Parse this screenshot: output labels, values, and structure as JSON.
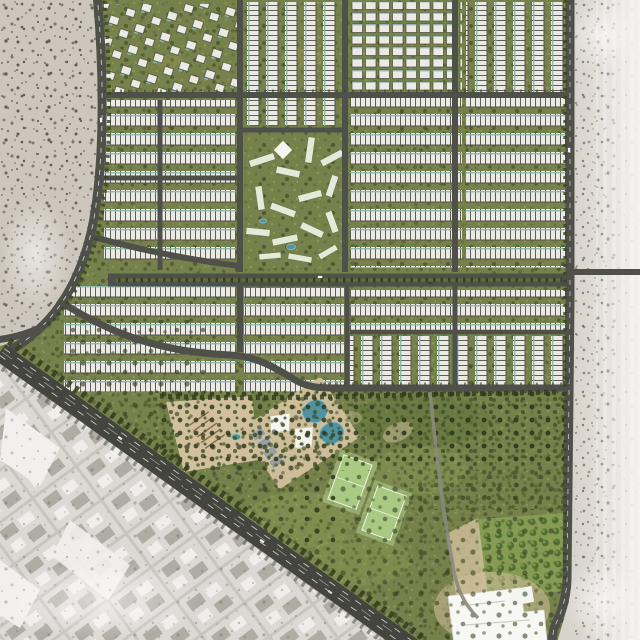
{
  "scene": {
    "name": "residential-masterplan-aerial",
    "description": "Top-down architectural rendering of a gated residential master-planned community surrounded by desert, an existing grayscale city district to the southwest and a diagonal arterial highway along its south-west edge",
    "canvas": {
      "width": 640,
      "height": 640
    }
  },
  "colors": {
    "left_desert": "#cdc6bc",
    "right_desert": "#d8d3cb",
    "city_base": "#dcd9d4",
    "city_block_gray": "#aba69e",
    "city_block_white": "#f2f0ec",
    "road": "#50504a",
    "road_major": "#454540",
    "lane_dash": "#c9c9c3",
    "dev_green": "#76814b",
    "green_dark": "#37411f",
    "green_light": "#9aa254",
    "housing_white": "#eae9e3",
    "housing_gap": "#45453c",
    "teal_accent": "#87b5ac",
    "villa_white": "#eceae4",
    "park_tree": "#2c3a1a",
    "median_green": "#5e6c3c",
    "pitch_green": "#a8ca82",
    "pitch_apron": "#b7d592",
    "pitch_line": "#edf4e2",
    "pool_blue": "#4f93a3",
    "sand": "#d2c09c",
    "amphitheater_brown": "#8a6b48",
    "court_gray": "#9aa0a0",
    "orchard_tree": "#4f6a2e",
    "mosque_white": "#f5f5f1",
    "speck_gray": "#7d776e"
  },
  "regions": [
    {
      "name": "desert-west",
      "desc": "light desert scrub with scattered dark trees"
    },
    {
      "name": "desert-east",
      "desc": "pale desert strip fading to white at image edge"
    },
    {
      "name": "city-southwest",
      "desc": "existing grayscale city blocks on a diagonal street grid"
    },
    {
      "name": "highway-diagonal",
      "desc": "multi-lane arterial road running NW-SE along the community edge"
    },
    {
      "name": "perimeter-road-west",
      "desc": "curved western boundary road"
    },
    {
      "name": "perimeter-road-east",
      "desc": "eastern boundary road with service spur into desert"
    },
    {
      "name": "villa-park-northwest",
      "desc": "detached villas scattered in parkland"
    },
    {
      "name": "townhouse-districts",
      "desc": "rows of white townhouses with teal accents and green alleys"
    },
    {
      "name": "apartment-cluster-central",
      "desc": "angled mid-rise apartment bars around a landscaped spine with shade canopy"
    },
    {
      "name": "central-boulevard",
      "desc": "east-west boulevard with planted median"
    },
    {
      "name": "community-park-south",
      "desc": "large park with plaza, amphitheatre, pools, shade sails and lawns"
    },
    {
      "name": "sports-pitches",
      "desc": "two lined football pitches"
    },
    {
      "name": "orchard-grid",
      "desc": "grid-planted orchard grove"
    },
    {
      "name": "mosque-complex",
      "desc": "white flat-roofed community/mosque complex on sand apron"
    }
  ],
  "features": {
    "football_pitches": 2,
    "swimming_pools": 3,
    "shade_canopies": 3,
    "amphitheatre_terraces": 5,
    "mosque_complex": 1
  }
}
